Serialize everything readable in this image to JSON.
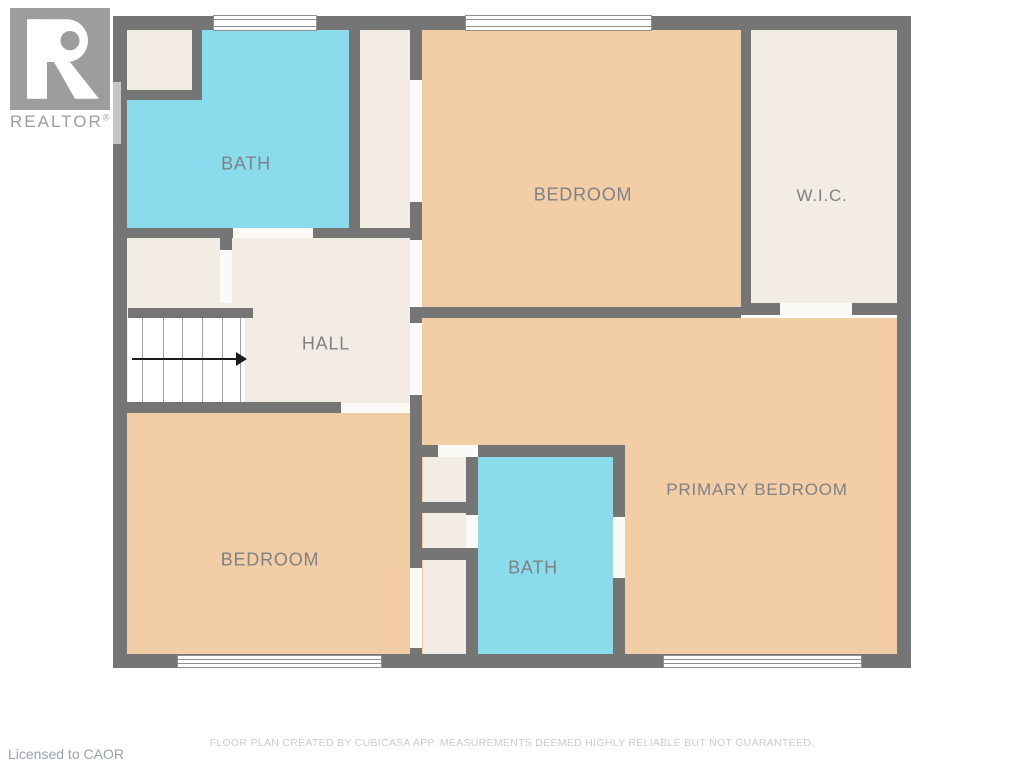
{
  "branding": {
    "logo_letter": "R",
    "logo_name": "REALTOR",
    "registered_mark": "®",
    "license_text": "Licensed to CAOR"
  },
  "rooms": {
    "bath_top": {
      "label": "BATH"
    },
    "bedroom_top": {
      "label": "BEDROOM"
    },
    "wic": {
      "label": "W.I.C."
    },
    "hall": {
      "label": "HALL"
    },
    "primary_bedroom": {
      "label": "PRIMARY BEDROOM"
    },
    "bath_bottom": {
      "label": "BATH"
    },
    "bedroom_bottom": {
      "label": "BEDROOM"
    }
  },
  "footer": {
    "disclaimer": "FLOOR PLAN CREATED BY CUBICASA APP. MEASUREMENTS DEEMED HIGHLY RELIABLE BUT NOT GUARANTEED."
  },
  "colors": {
    "wall": "#757575",
    "bedroom_fill": "#f2cda6",
    "bath_fill": "#8adced",
    "closet_fill": "#f3ece5",
    "door_fill": "#fbfaf7",
    "window_line": "#8f8f8f",
    "label_text": "#7e8285",
    "logo_gray": "#9d9d9d",
    "disclaimer_text": "#cccccc",
    "license_text": "#99a1ab"
  }
}
